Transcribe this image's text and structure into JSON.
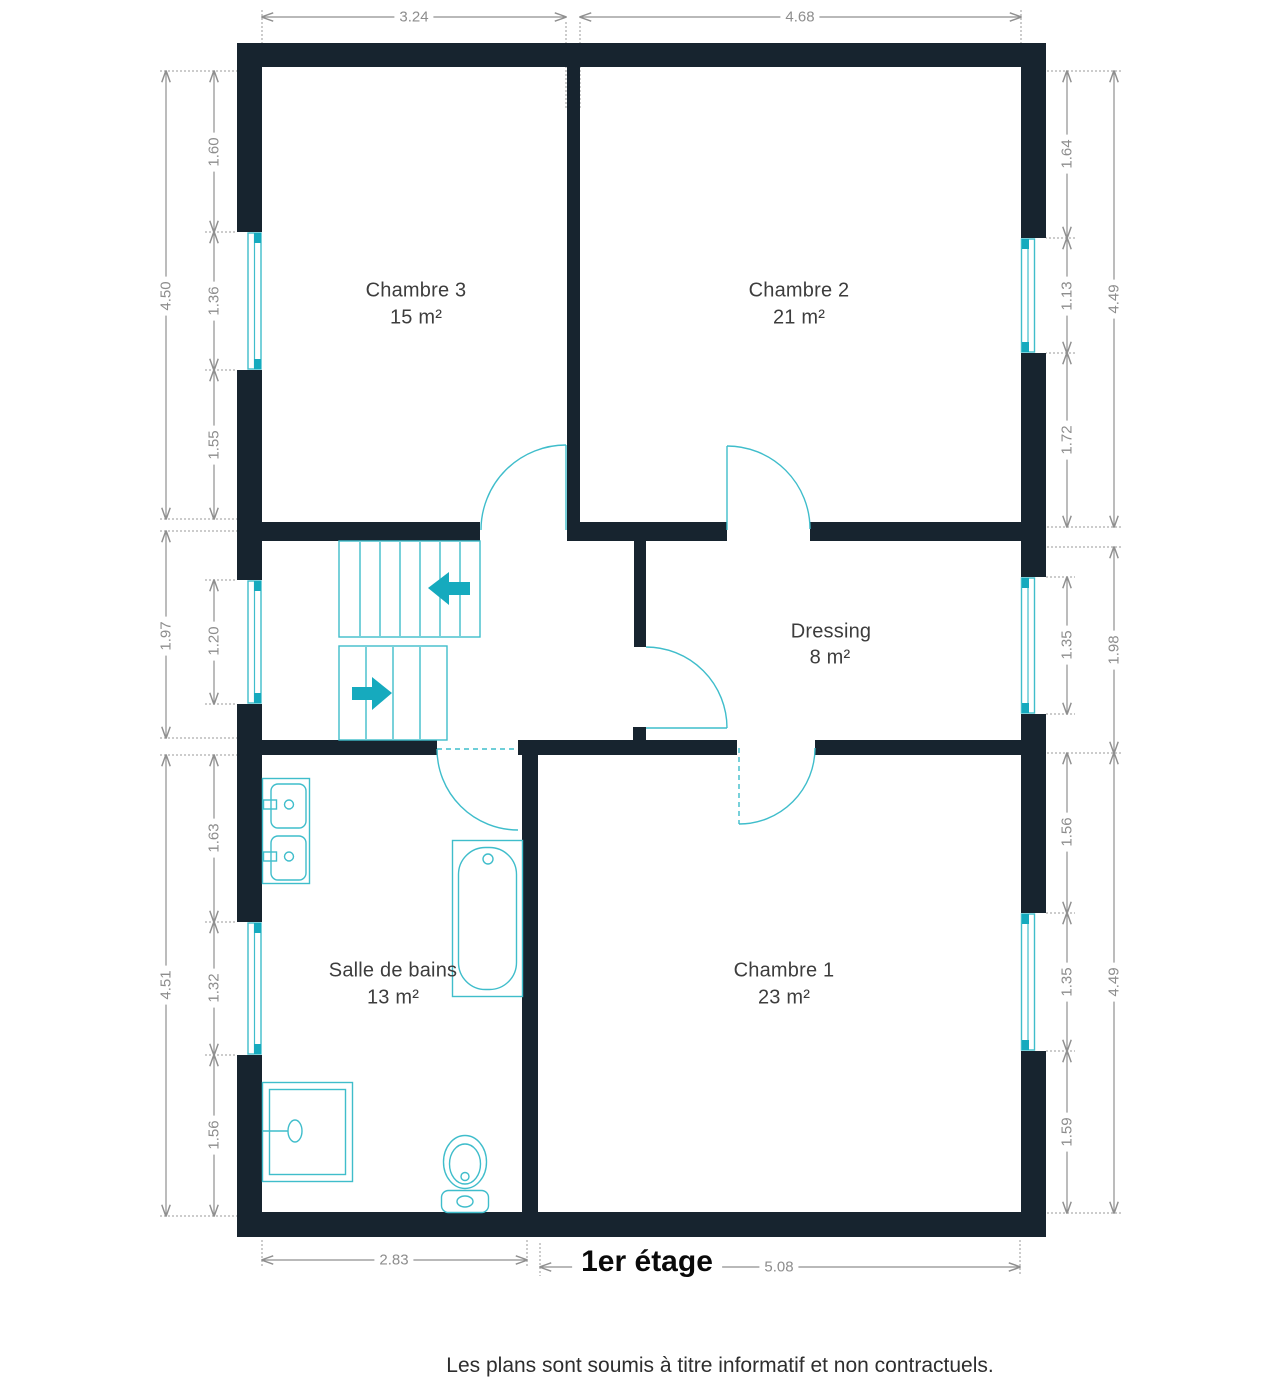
{
  "floor": {
    "title": "1er étage",
    "disclaimer": "Les plans sont soumis à titre informatif et non contractuels."
  },
  "rooms": [
    {
      "name": "Chambre 3",
      "area": "15 m²"
    },
    {
      "name": "Chambre 2",
      "area": "21 m²"
    },
    {
      "name": "Dressing",
      "area": "8 m²"
    },
    {
      "name": "Salle de bains",
      "area": "13 m²"
    },
    {
      "name": "Chambre 1",
      "area": "23 m²"
    }
  ],
  "dimensions": {
    "top_left": "3.24",
    "top_right": "4.68",
    "bottom_left": "2.83",
    "bottom_right": "5.08",
    "left_outer_top": "4.50",
    "left_outer_mid": "1.97",
    "left_outer_bottom": "4.51",
    "left_top_1": "1.60",
    "left_top_2": "1.36",
    "left_top_3": "1.55",
    "left_mid_window": "1.20",
    "left_bottom_1": "1.63",
    "left_bottom_2": "1.32",
    "left_bottom_3": "1.56",
    "right_top_1": "1.64",
    "right_top_2": "1.13",
    "right_top_3": "1.72",
    "right_outer_top": "4.49",
    "right_mid_window": "1.35",
    "right_outer_mid": "1.98",
    "right_bottom_1": "1.56",
    "right_bottom_2": "1.35",
    "right_bottom_3": "1.59",
    "right_outer_bottom": "4.49"
  },
  "colors": {
    "wall": "#17242f",
    "fixture_line": "#3fbdcb",
    "fixture_solid": "#16aabe",
    "dimension": "#8f8f8f"
  }
}
